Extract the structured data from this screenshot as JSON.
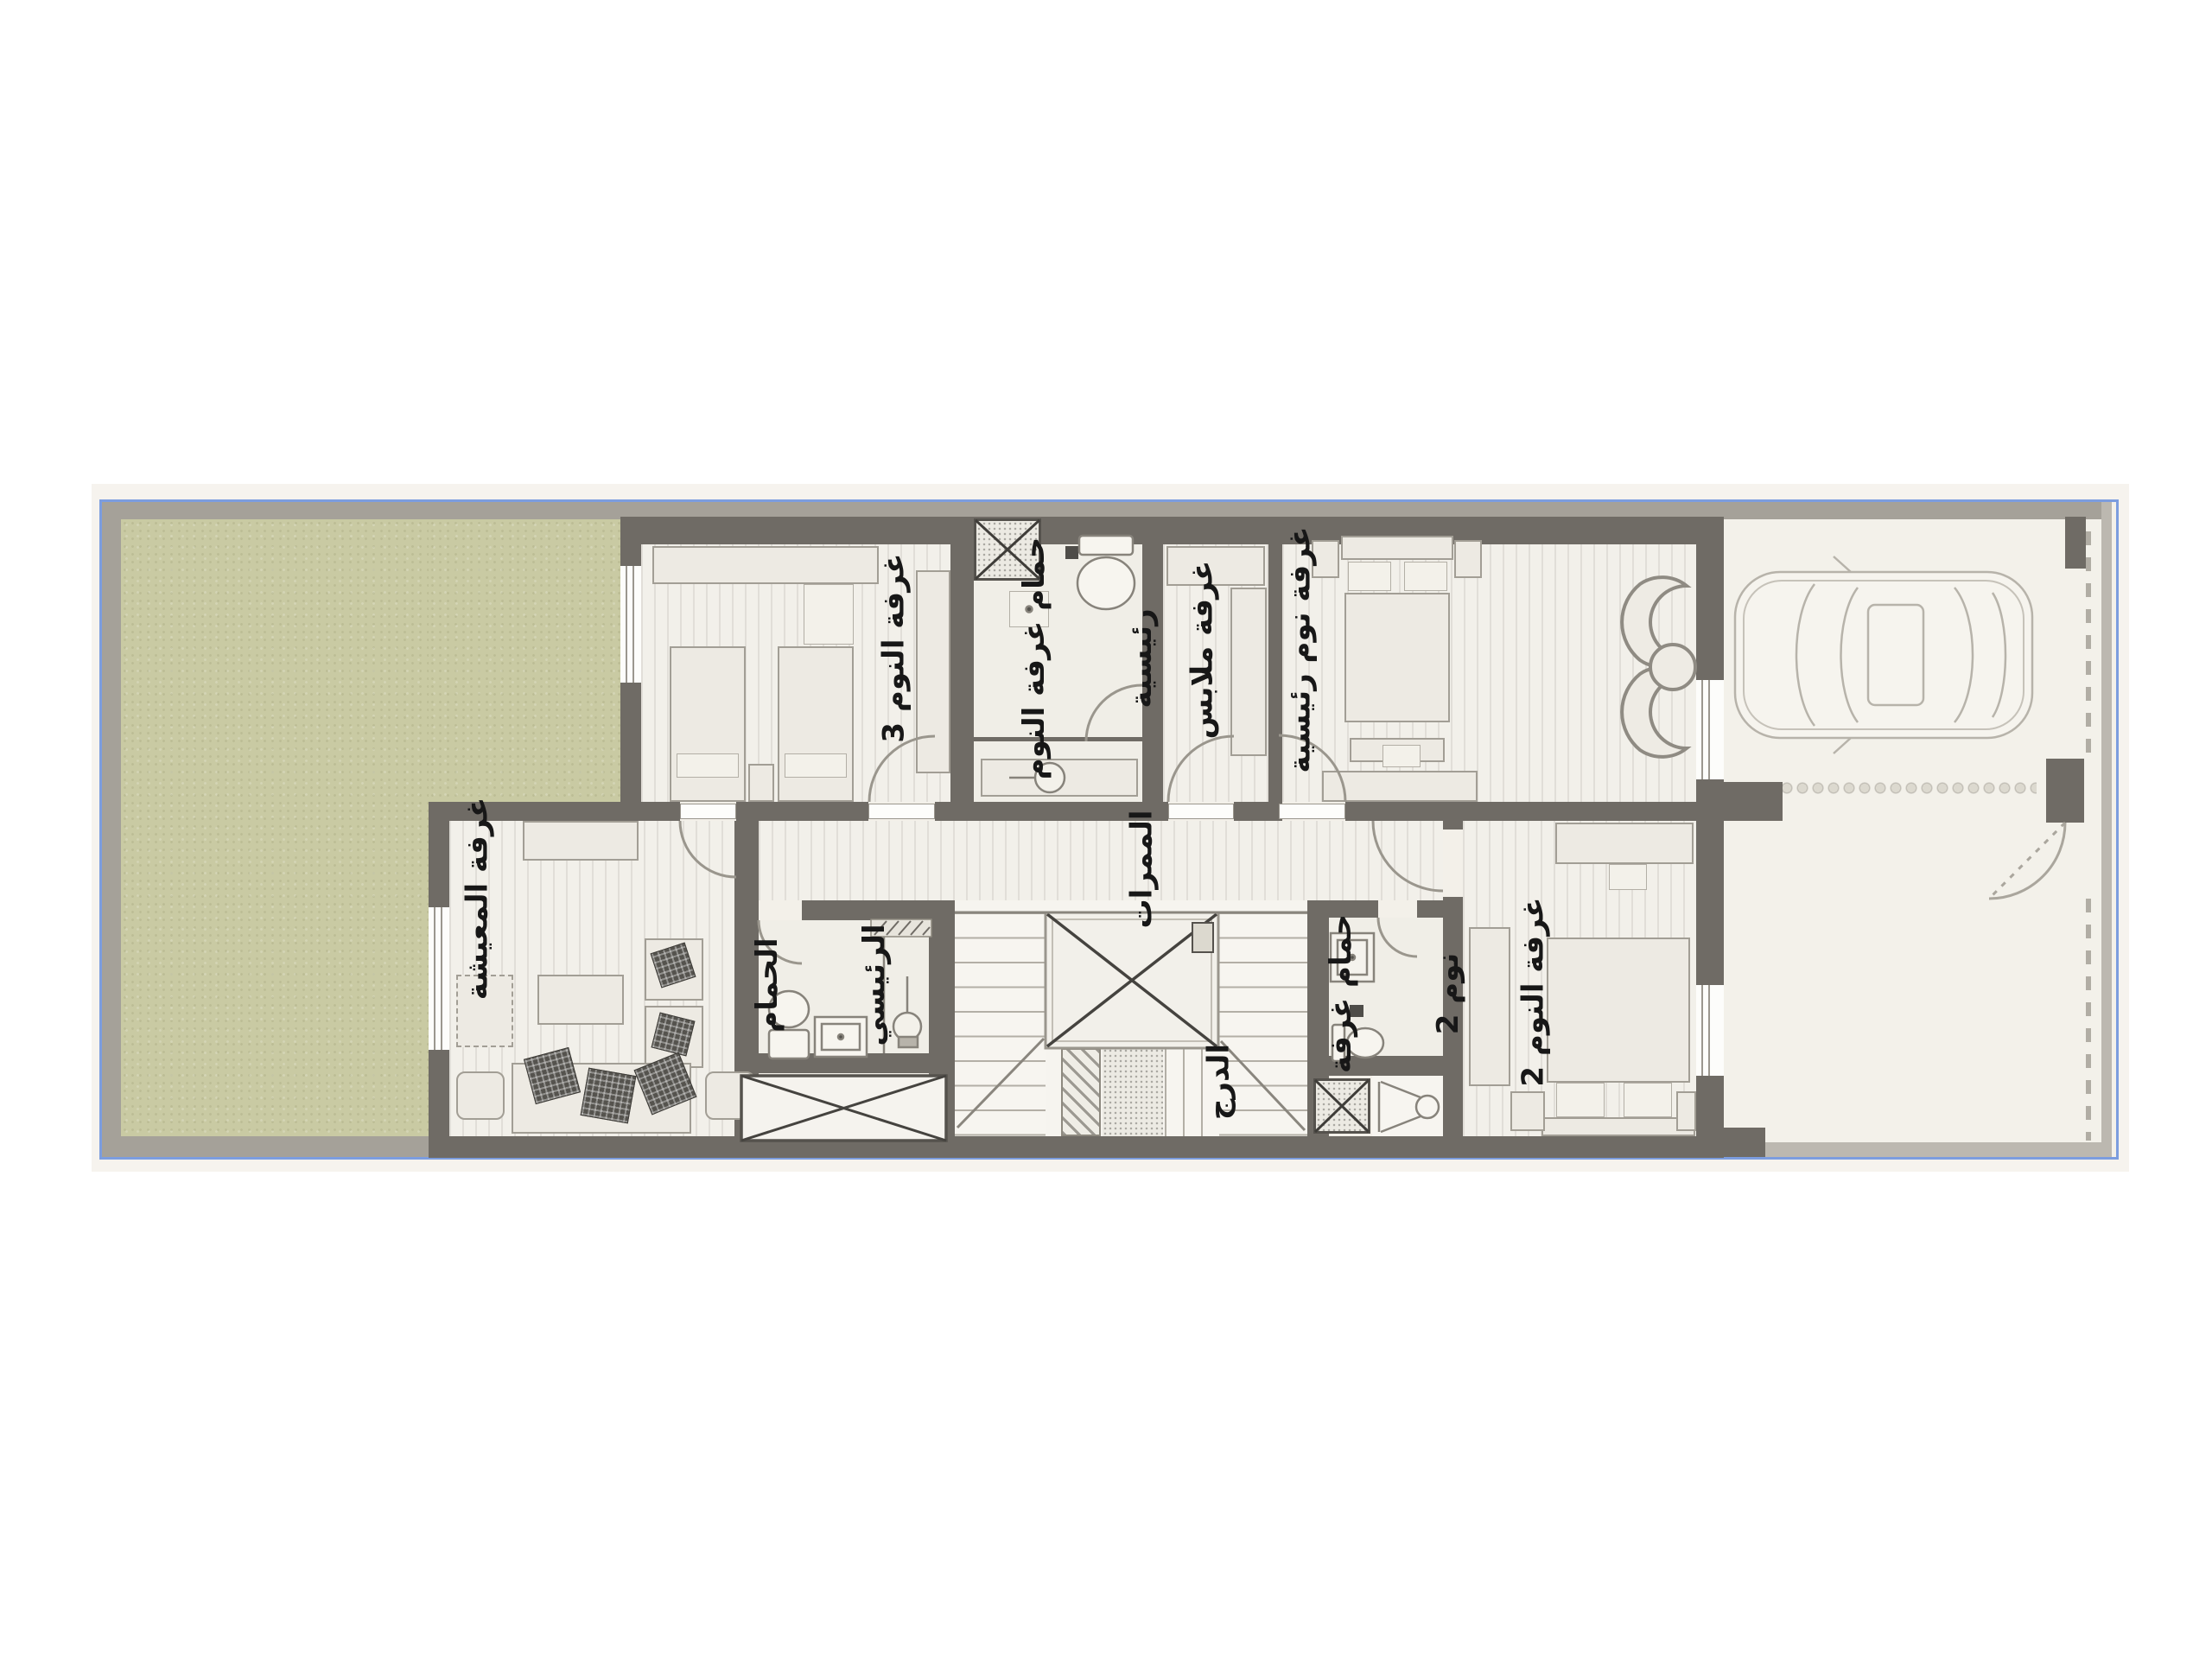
{
  "document": {
    "type": "residential-floor-plan",
    "language": "Arabic",
    "view": "top-down architectural plan with garden, garage and staircase"
  },
  "labels": {
    "bedroom3": "غرفة النوم 3",
    "master_bath_line1": "حمام غرفة النوم",
    "master_bath_line2": "رئيسية",
    "dressing": "غرفة ملابس",
    "master_bedroom": "غرفة نوم رئيسية",
    "living": "غرفة المعيشة",
    "corridors": "الممرات",
    "stairs": "الدرج",
    "main_bath_line1": "الحمام",
    "main_bath_line2": "الرئيسي",
    "bath2_line1": "حمام غرفة",
    "bath2_line2": "نوم 2",
    "bedroom2": "غرفة النوم 2"
  },
  "colors": {
    "wall": "#6f6b65",
    "plot_border_blue": "#7c9ddf",
    "plot_background": "#f3f0e9",
    "garden_green": "#c9caa3",
    "floor": "#f2f0ea",
    "furniture_fill": "#edeae3",
    "furniture_line": "#a29e95",
    "label_text": "#171717"
  },
  "icons": {
    "car": "car-top-view-icon",
    "toilet": "toilet-icon",
    "sink": "sink-icon",
    "shower": "shower-icon",
    "shower_head": "shower-head-icon",
    "vanity_basin": "vanity-basin-icon",
    "double_bed": "double-bed-icon",
    "single_bed": "single-bed-icon",
    "wardrobe": "wardrobe-icon",
    "sofa": "sofa-icon",
    "armchair": "armchair-icon",
    "coffee_table": "coffee-table-icon",
    "tv_console": "tv-console-icon",
    "curved_chaise": "curved-chaise-icon",
    "stair_void": "void-x-icon",
    "shaft": "shaft-x-icon",
    "door_swing": "door-arc-icon",
    "window": "window-icon",
    "gate": "gate-arc-icon"
  }
}
